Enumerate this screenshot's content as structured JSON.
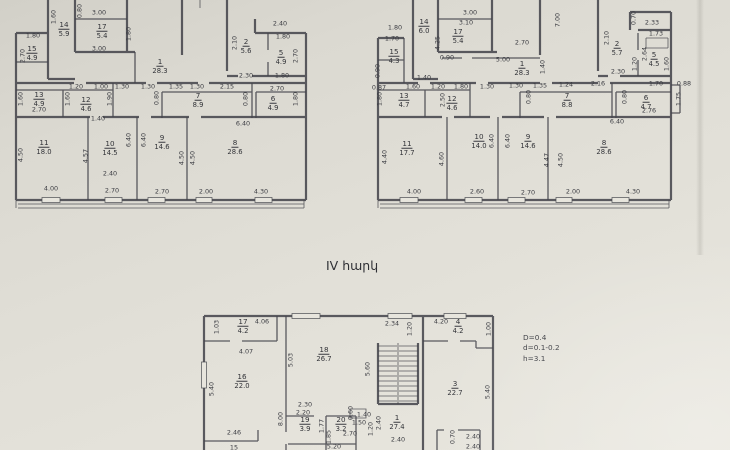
{
  "page": {
    "floor_label": "IV հարկ",
    "notes": [
      "D=0.4",
      "d=0.1-0.2",
      "h=3.1"
    ]
  },
  "plans": [
    {
      "id": "upper-left",
      "rooms": [
        {
          "n": "14",
          "a": "5.9",
          "x": 64,
          "y": 29
        },
        {
          "n": "17",
          "a": "5.4",
          "x": 102,
          "y": 31
        },
        {
          "n": "15",
          "a": "4.9",
          "x": 32,
          "y": 53
        },
        {
          "n": "1",
          "a": "28.3",
          "x": 160,
          "y": 66
        },
        {
          "n": "2",
          "a": "5.6",
          "x": 246,
          "y": 46
        },
        {
          "n": "5",
          "a": "4.9",
          "x": 281,
          "y": 57
        },
        {
          "n": "13",
          "a": "4.9",
          "x": 39,
          "y": 99
        },
        {
          "n": "12",
          "a": "4.6",
          "x": 86,
          "y": 104
        },
        {
          "n": "7",
          "a": "8.9",
          "x": 198,
          "y": 100
        },
        {
          "n": "6",
          "a": "4.9",
          "x": 273,
          "y": 103
        },
        {
          "n": "11",
          "a": "18.0",
          "x": 44,
          "y": 147
        },
        {
          "n": "10",
          "a": "14.5",
          "x": 110,
          "y": 148
        },
        {
          "n": "9",
          "a": "14.6",
          "x": 162,
          "y": 142
        },
        {
          "n": "8",
          "a": "28.6",
          "x": 235,
          "y": 147
        }
      ],
      "dims": [
        {
          "t": "3.00",
          "x": 99,
          "y": 13
        },
        {
          "t": "2.40",
          "x": 280,
          "y": 24
        },
        {
          "t": "1.80",
          "x": 33,
          "y": 36
        },
        {
          "t": "1.80",
          "x": 283,
          "y": 37
        },
        {
          "t": "3.00",
          "x": 99,
          "y": 49
        },
        {
          "t": "1.60",
          "x": 54,
          "y": 17,
          "r": 1
        },
        {
          "t": "0.80",
          "x": 80,
          "y": 11,
          "r": 1
        },
        {
          "t": "1.80",
          "x": 129,
          "y": 34,
          "r": 1
        },
        {
          "t": "2.70",
          "x": 23,
          "y": 56,
          "r": 1
        },
        {
          "t": "2.10",
          "x": 235,
          "y": 43,
          "r": 1
        },
        {
          "t": "2.70",
          "x": 296,
          "y": 56,
          "r": 1
        },
        {
          "t": "2.30",
          "x": 246,
          "y": 76
        },
        {
          "t": "1.80",
          "x": 282,
          "y": 76
        },
        {
          "t": "1.20",
          "x": 76,
          "y": 87
        },
        {
          "t": "1.00",
          "x": 101,
          "y": 87
        },
        {
          "t": "1.30",
          "x": 122,
          "y": 87
        },
        {
          "t": "1.30",
          "x": 148,
          "y": 87
        },
        {
          "t": "1.35",
          "x": 176,
          "y": 87
        },
        {
          "t": "1.30",
          "x": 197,
          "y": 87
        },
        {
          "t": "2.15",
          "x": 227,
          "y": 87
        },
        {
          "t": "2.70",
          "x": 277,
          "y": 89
        },
        {
          "t": "1.60",
          "x": 21,
          "y": 99,
          "r": 1
        },
        {
          "t": "1.60",
          "x": 68,
          "y": 99,
          "r": 1
        },
        {
          "t": "1.90",
          "x": 110,
          "y": 99,
          "r": 1
        },
        {
          "t": "0.80",
          "x": 157,
          "y": 98,
          "r": 1
        },
        {
          "t": "0.80",
          "x": 246,
          "y": 99,
          "r": 1
        },
        {
          "t": "1.80",
          "x": 296,
          "y": 99,
          "r": 1
        },
        {
          "t": "2.70",
          "x": 39,
          "y": 110
        },
        {
          "t": "1.40",
          "x": 98,
          "y": 119
        },
        {
          "t": "6.40",
          "x": 243,
          "y": 124
        },
        {
          "t": "6.40",
          "x": 129,
          "y": 140,
          "r": 1
        },
        {
          "t": "6.40",
          "x": 144,
          "y": 140,
          "r": 1
        },
        {
          "t": "4.50",
          "x": 21,
          "y": 155,
          "r": 1
        },
        {
          "t": "4.57",
          "x": 86,
          "y": 156,
          "r": 1
        },
        {
          "t": "4.50",
          "x": 182,
          "y": 158,
          "r": 1
        },
        {
          "t": "4.50",
          "x": 193,
          "y": 158,
          "r": 1
        },
        {
          "t": "2.40",
          "x": 110,
          "y": 174
        },
        {
          "t": "4.00",
          "x": 51,
          "y": 189
        },
        {
          "t": "2.70",
          "x": 112,
          "y": 191
        },
        {
          "t": "2.70",
          "x": 162,
          "y": 192
        },
        {
          "t": "2.00",
          "x": 206,
          "y": 192
        },
        {
          "t": "4.30",
          "x": 261,
          "y": 192
        }
      ]
    },
    {
      "id": "upper-right",
      "rooms": [
        {
          "n": "14",
          "a": "6.0",
          "x": 424,
          "y": 26
        },
        {
          "n": "17",
          "a": "5.4",
          "x": 458,
          "y": 36
        },
        {
          "n": "15",
          "a": "4.3",
          "x": 394,
          "y": 56
        },
        {
          "n": "1",
          "a": "28.3",
          "x": 522,
          "y": 68
        },
        {
          "n": "2",
          "a": "5.7",
          "x": 617,
          "y": 48
        },
        {
          "n": "5",
          "a": "4.5",
          "x": 654,
          "y": 59
        },
        {
          "n": "13",
          "a": "4.7",
          "x": 404,
          "y": 100
        },
        {
          "n": "12",
          "a": "4.6",
          "x": 452,
          "y": 103
        },
        {
          "n": "7",
          "a": "8.8",
          "x": 567,
          "y": 100
        },
        {
          "n": "6",
          "a": "4.7",
          "x": 646,
          "y": 102
        },
        {
          "n": "11",
          "a": "17.7",
          "x": 407,
          "y": 148
        },
        {
          "n": "10",
          "a": "14.0",
          "x": 479,
          "y": 141
        },
        {
          "n": "9",
          "a": "14.6",
          "x": 528,
          "y": 141
        },
        {
          "n": "8",
          "a": "28.6",
          "x": 604,
          "y": 147
        }
      ],
      "dims": [
        {
          "t": "1.80",
          "x": 395,
          "y": 28
        },
        {
          "t": "3.00",
          "x": 470,
          "y": 13
        },
        {
          "t": "3.10",
          "x": 466,
          "y": 23
        },
        {
          "t": "7.00",
          "x": 558,
          "y": 20,
          "r": 1
        },
        {
          "t": "0.70",
          "x": 634,
          "y": 18,
          "r": 1
        },
        {
          "t": "2.33",
          "x": 652,
          "y": 23
        },
        {
          "t": "1.73",
          "x": 656,
          "y": 34
        },
        {
          "t": "2.10",
          "x": 607,
          "y": 38,
          "r": 1
        },
        {
          "t": "2.70",
          "x": 522,
          "y": 43
        },
        {
          "t": "1.70",
          "x": 392,
          "y": 39
        },
        {
          "t": "4.25",
          "x": 438,
          "y": 43,
          "r": 1
        },
        {
          "t": "5.00",
          "x": 503,
          "y": 60
        },
        {
          "t": "0.90",
          "x": 447,
          "y": 58
        },
        {
          "t": "1.40",
          "x": 543,
          "y": 67,
          "r": 1
        },
        {
          "t": "2.30",
          "x": 618,
          "y": 72
        },
        {
          "t": "1.40",
          "x": 424,
          "y": 78
        },
        {
          "t": "0.90",
          "x": 378,
          "y": 71,
          "r": 1
        },
        {
          "t": "2.64",
          "x": 645,
          "y": 54,
          "r": 1
        },
        {
          "t": "1.20",
          "x": 635,
          "y": 64,
          "r": 1
        },
        {
          "t": "1.60",
          "x": 667,
          "y": 64,
          "r": 1
        },
        {
          "t": "0.87",
          "x": 379,
          "y": 88
        },
        {
          "t": "1.60",
          "x": 413,
          "y": 87
        },
        {
          "t": "1.20",
          "x": 438,
          "y": 87
        },
        {
          "t": "1.80",
          "x": 461,
          "y": 87
        },
        {
          "t": "1.30",
          "x": 487,
          "y": 87
        },
        {
          "t": "1.30",
          "x": 516,
          "y": 86
        },
        {
          "t": "1.35",
          "x": 540,
          "y": 86
        },
        {
          "t": "1.24",
          "x": 566,
          "y": 85
        },
        {
          "t": "2.16",
          "x": 598,
          "y": 84
        },
        {
          "t": "1.70",
          "x": 656,
          "y": 84
        },
        {
          "t": "0.88",
          "x": 684,
          "y": 84
        },
        {
          "t": "1.80",
          "x": 380,
          "y": 99,
          "r": 1
        },
        {
          "t": "2.50",
          "x": 443,
          "y": 100,
          "r": 1
        },
        {
          "t": "0.80",
          "x": 529,
          "y": 97,
          "r": 1
        },
        {
          "t": "0.80",
          "x": 625,
          "y": 97,
          "r": 1
        },
        {
          "t": "1.75",
          "x": 679,
          "y": 99,
          "r": 1
        },
        {
          "t": "2.76",
          "x": 649,
          "y": 111
        },
        {
          "t": "6.40",
          "x": 617,
          "y": 122
        },
        {
          "t": "4.40",
          "x": 385,
          "y": 157,
          "r": 1
        },
        {
          "t": "4.60",
          "x": 442,
          "y": 159,
          "r": 1
        },
        {
          "t": "6.40",
          "x": 492,
          "y": 141,
          "r": 1
        },
        {
          "t": "6.40",
          "x": 508,
          "y": 141,
          "r": 1
        },
        {
          "t": "4.47",
          "x": 547,
          "y": 160,
          "r": 1
        },
        {
          "t": "4.50",
          "x": 561,
          "y": 160,
          "r": 1
        },
        {
          "t": "4.00",
          "x": 414,
          "y": 192
        },
        {
          "t": "2.60",
          "x": 477,
          "y": 192
        },
        {
          "t": "2.70",
          "x": 528,
          "y": 193
        },
        {
          "t": "2.00",
          "x": 573,
          "y": 192
        },
        {
          "t": "4.30",
          "x": 633,
          "y": 192
        }
      ]
    },
    {
      "id": "bottom",
      "rooms": [
        {
          "n": "17",
          "a": "4.2",
          "x": 243,
          "y": 326
        },
        {
          "n": "16",
          "a": "22.0",
          "x": 242,
          "y": 381
        },
        {
          "n": "18",
          "a": "26.7",
          "x": 324,
          "y": 354
        },
        {
          "n": "19",
          "a": "3.9",
          "x": 305,
          "y": 424
        },
        {
          "n": "20",
          "a": "3.2",
          "x": 341,
          "y": 424
        },
        {
          "n": "1",
          "a": "27.4",
          "x": 397,
          "y": 422
        },
        {
          "n": "4",
          "a": "4.2",
          "x": 458,
          "y": 326
        },
        {
          "n": "3",
          "a": "22.7",
          "x": 455,
          "y": 388
        }
      ],
      "dims": [
        {
          "t": "1.03",
          "x": 217,
          "y": 327,
          "r": 1
        },
        {
          "t": "4.06",
          "x": 262,
          "y": 322
        },
        {
          "t": "4.07",
          "x": 246,
          "y": 352
        },
        {
          "t": "5.40",
          "x": 212,
          "y": 389,
          "r": 1
        },
        {
          "t": "2.46",
          "x": 234,
          "y": 433
        },
        {
          "t": "15",
          "x": 234,
          "y": 448
        },
        {
          "t": "5.03",
          "x": 291,
          "y": 360,
          "r": 1
        },
        {
          "t": "5.60",
          "x": 368,
          "y": 369,
          "r": 1
        },
        {
          "t": "2.30",
          "x": 305,
          "y": 405
        },
        {
          "t": "2.20",
          "x": 303,
          "y": 413
        },
        {
          "t": "8.00",
          "x": 281,
          "y": 419,
          "r": 1
        },
        {
          "t": "1.77",
          "x": 322,
          "y": 426,
          "r": 1
        },
        {
          "t": "1.85",
          "x": 329,
          "y": 437,
          "r": 1
        },
        {
          "t": "0.60",
          "x": 351,
          "y": 413,
          "r": 1
        },
        {
          "t": "1.40",
          "x": 364,
          "y": 415
        },
        {
          "t": "1.50",
          "x": 359,
          "y": 423
        },
        {
          "t": "2.70",
          "x": 350,
          "y": 434
        },
        {
          "t": "1.20",
          "x": 371,
          "y": 429,
          "r": 1
        },
        {
          "t": "2.40",
          "x": 379,
          "y": 423,
          "r": 1
        },
        {
          "t": "2.40",
          "x": 398,
          "y": 440
        },
        {
          "t": "5.20",
          "x": 334,
          "y": 447
        },
        {
          "t": "2.34",
          "x": 392,
          "y": 324
        },
        {
          "t": "1.20",
          "x": 410,
          "y": 329,
          "r": 1
        },
        {
          "t": "4.20",
          "x": 441,
          "y": 322
        },
        {
          "t": "1.00",
          "x": 489,
          "y": 329,
          "r": 1
        },
        {
          "t": "5.40",
          "x": 488,
          "y": 392,
          "r": 1
        },
        {
          "t": "0.70",
          "x": 453,
          "y": 437,
          "r": 1
        },
        {
          "t": "2.40",
          "x": 473,
          "y": 437
        },
        {
          "t": "2.40",
          "x": 473,
          "y": 447
        }
      ]
    }
  ]
}
